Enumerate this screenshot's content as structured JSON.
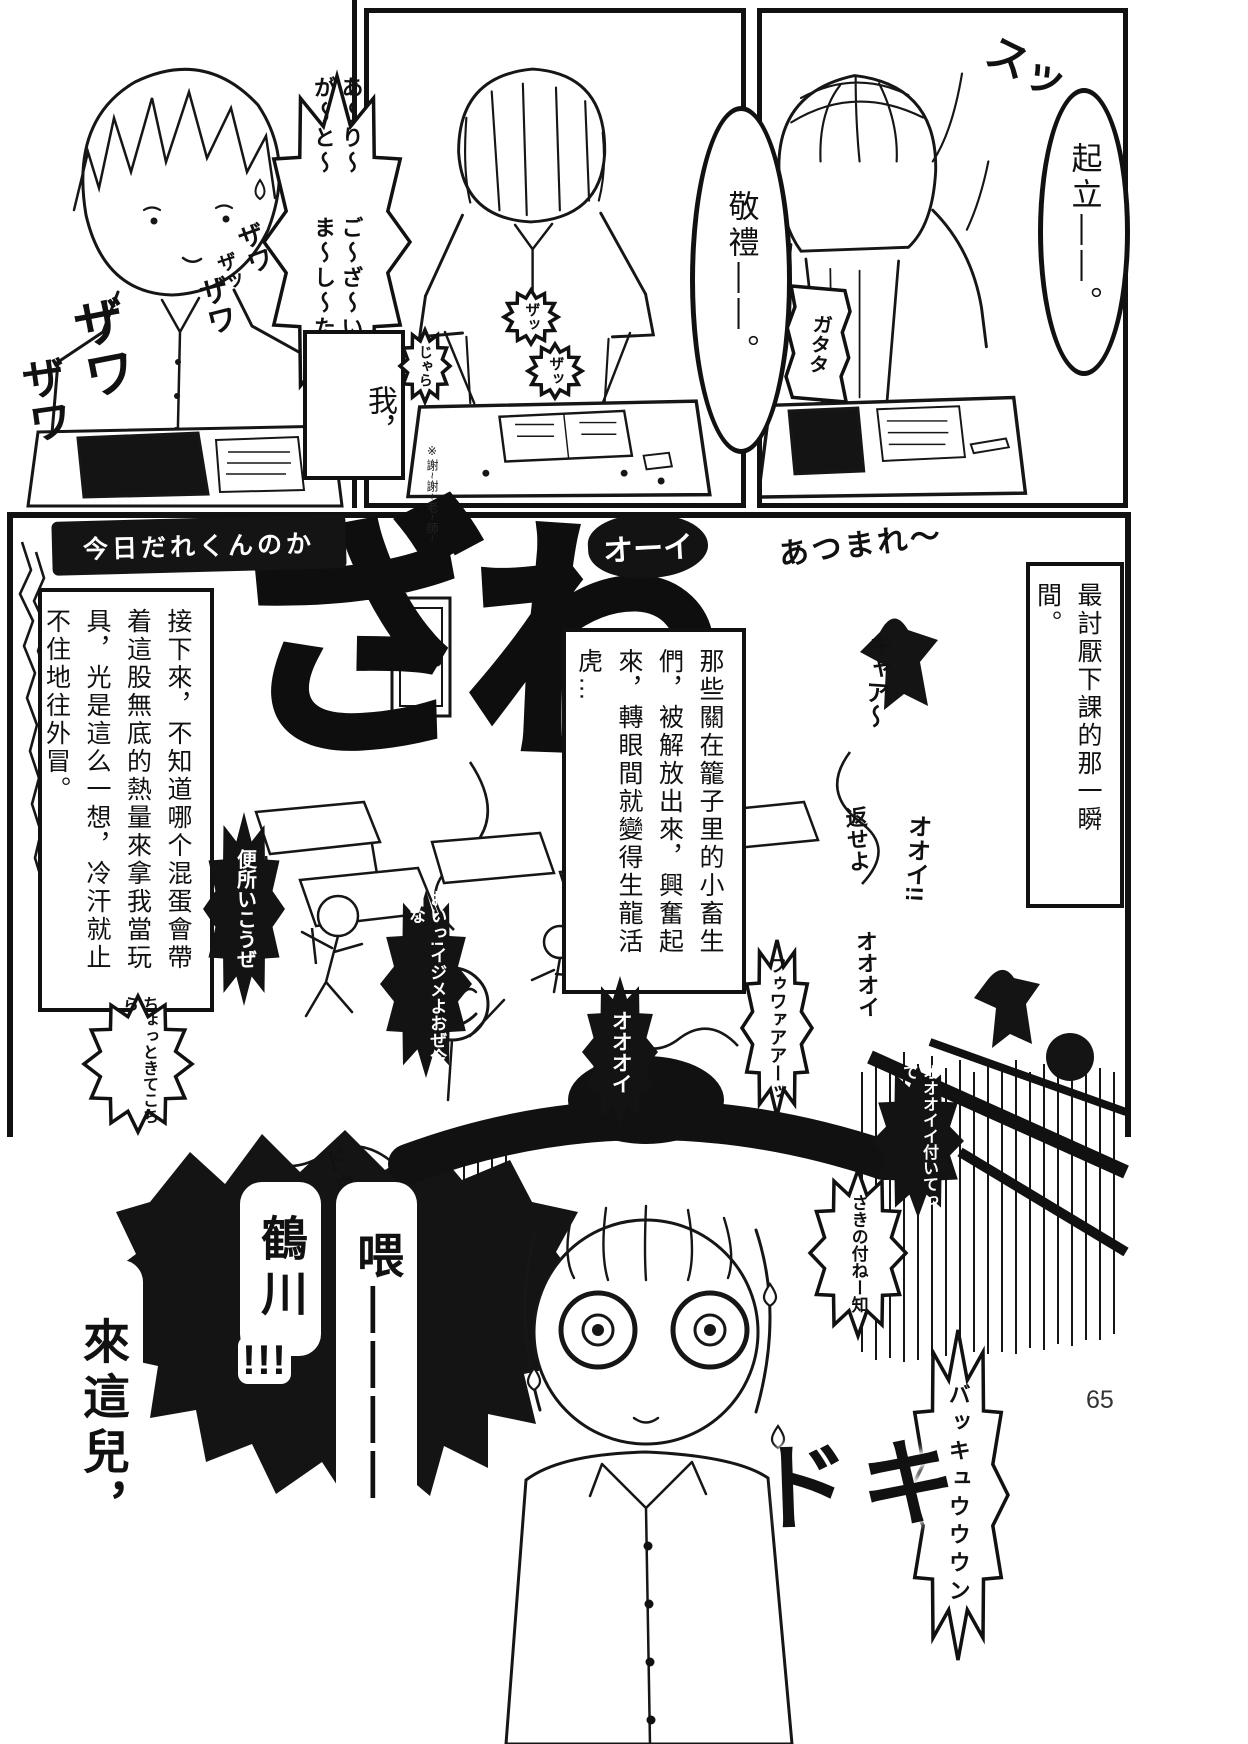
{
  "page": {
    "number": "65",
    "bg": "#ffffff",
    "ink": "#111111"
  },
  "p1": {
    "sfx": [
      "ザワ",
      "ザワ",
      "ザワ",
      "ザワ",
      "ザッ"
    ],
    "thanks_a": "あ〜り〜が〜と〜",
    "thanks_b": "ご〜ざ〜い〜ま〜し〜た",
    "wa": "我，",
    "note": "※謝~謝~老~師~"
  },
  "p2": {
    "bubble": "敬禮——。",
    "zatsu1": "ザッ",
    "zatsu2": "ザッ",
    "jara": "じゃら"
  },
  "p3": {
    "bubble": "起立——。",
    "su": "スッ",
    "gatata": "ガタタ"
  },
  "main": {
    "chalk": "今日だれくんのか",
    "nar_right": "最討厭下課的那一瞬間。",
    "nar_mid": "那些關在籠子里的小畜生們，被解放出來，興奮起來，轉眼間就變得生龍活虎…",
    "nar_left": "接下來，不知道哪个混蛋會帶着這股無底的熱量來拿我當玩具，光是這么一想，冷汗就止不住地往外冒。",
    "graffiti": [
      "ざ",
      "わ"
    ],
    "ooi_outline": "オーイ",
    "atsumare": "あつまれ〜",
    "kyaa": "キャア〜",
    "kaese": "返せよ",
    "ooi_bang": "オオイ!!",
    "oooi_small": "オオオイ",
    "benjo": "便所いこうぜ",
    "ijime": "おいっ!イジメよおぜ今日な",
    "chotto": "ちょっときてこちら",
    "oooi_blob": "オオオイ",
    "fuwaa": "フゥワァアアーッ",
    "tsuite": "オオオイイ付いてって",
    "sakino": "さきの付ねー知",
    "doudou": "ドゥドゥッ",
    "call_hey": "喂————",
    "call_name": "鶴川",
    "call_bang": "!!!",
    "call_come": "來這兒，",
    "doki": "ドキ",
    "bakyuun": "バッキュウウウン"
  }
}
